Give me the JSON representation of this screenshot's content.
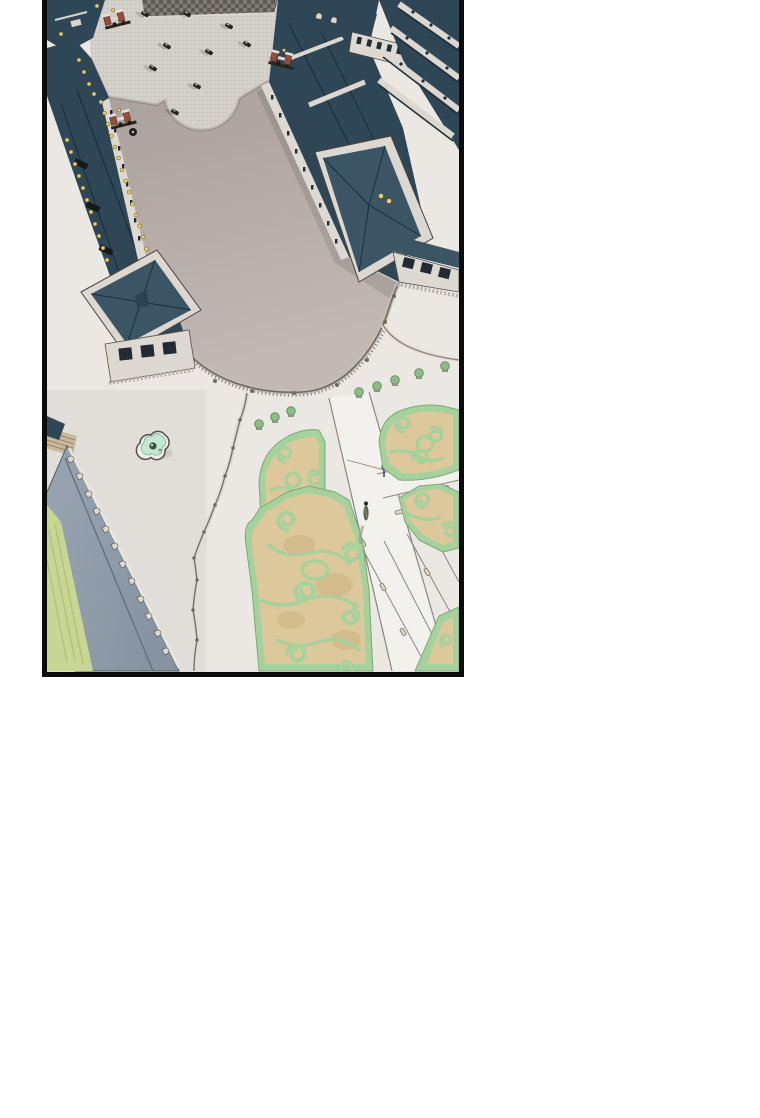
{
  "page": {
    "background": "#ffffff"
  },
  "panel": {
    "title": "webtoon-aerial-palace-panel",
    "description": "Bird's-eye aerial illustration of a grand palace: U-shaped wings with dark teal roofs around a cobblestone forecourt, a large taupe plaza bounded by a curved balustrade, a quatrefoil fountain, a long gray-roofed service wing beside a green lawn, and formal parterre gardens with scrolled hedges, white paths, potted shrubs and a lone walking figure.",
    "border_color": "#0c0c0c",
    "x": 42,
    "y": 0,
    "width": 422,
    "height": 677
  },
  "palette": {
    "page-bg": "#ffffff",
    "ink": "#0c0c0c",
    "ground-white": "#ebe8e3",
    "cobble-base": "#d5d2cb",
    "cobble-grid": "#c2beb7",
    "boundary-line": "#7b756e",
    "plaza-top": "#a99f9b",
    "plaza-bottom": "#c2b9b4",
    "roof-teal": "#2e4655",
    "roof-teal-light": "#3b5565",
    "ridge-dark": "#1c2f3b",
    "white-trim": "#dcd8d1",
    "facade-white": "#ddd9d2",
    "window-dark": "#202b33",
    "gold": "#e8d06c",
    "gate-red": "#92503c",
    "gray-roof": "#8694a2",
    "gray-roof-light": "#9aa6b2",
    "gray-ridge": "#5d6b78",
    "lawn-green": "#c9d592",
    "lawn-stripe": "#b2c37c",
    "hedge-green": "#a5d19d",
    "hedge-deep": "#7fa878",
    "parterre-tan": "#dcc89b",
    "blob-tan": "#d2bc8b",
    "path-white": "#f3f1ed",
    "path-edge": "#8b857e",
    "fountain-water": "#c3e7d3",
    "fountain-rim": "#f1efeb",
    "fountain-dark": "#40514a",
    "figure-olive": "#5c6152",
    "checker-dark": "#5e5b56",
    "checker-light": "#807c76"
  },
  "scene": {
    "elements": [
      {
        "name": "forecourt-cobblestone",
        "desc": "fine-grid cobbled court with scattered carriages and people"
      },
      {
        "name": "left-wing",
        "desc": "dark teal roofed wing with gilded eave ornaments and roof hatches"
      },
      {
        "name": "right-wing",
        "desc": "dark teal roofed wing with white trim bands and end pavilion"
      },
      {
        "name": "left-pavilion",
        "desc": "hip-roofed pavilion with pediment windows"
      },
      {
        "name": "right-pavilion",
        "desc": "hip-roofed pavilion with attic window cornice"
      },
      {
        "name": "gates",
        "desc": "three red-brown ornamental gate structures"
      },
      {
        "name": "grand-plaza",
        "desc": "smooth taupe plaza edged by a sweeping balustrade"
      },
      {
        "name": "fountain",
        "desc": "quatrefoil basin with mint water and center sculpture"
      },
      {
        "name": "service-wing",
        "desc": "long gray-blue roof with dormer row beside a striped lawn"
      },
      {
        "name": "terrace-edge",
        "desc": "scalloped balustraded terrace boundary"
      },
      {
        "name": "parterre-gardens",
        "desc": "five hedge-scroll parterre beds on tan ground"
      },
      {
        "name": "garden-paths",
        "desc": "white walks with planter benches and a lamppost"
      },
      {
        "name": "walking-figure",
        "desc": "single figure casting a long shadow on the main walk"
      },
      {
        "name": "potted-shrubs",
        "desc": "row of potted shrubs along the balustrade"
      }
    ]
  }
}
